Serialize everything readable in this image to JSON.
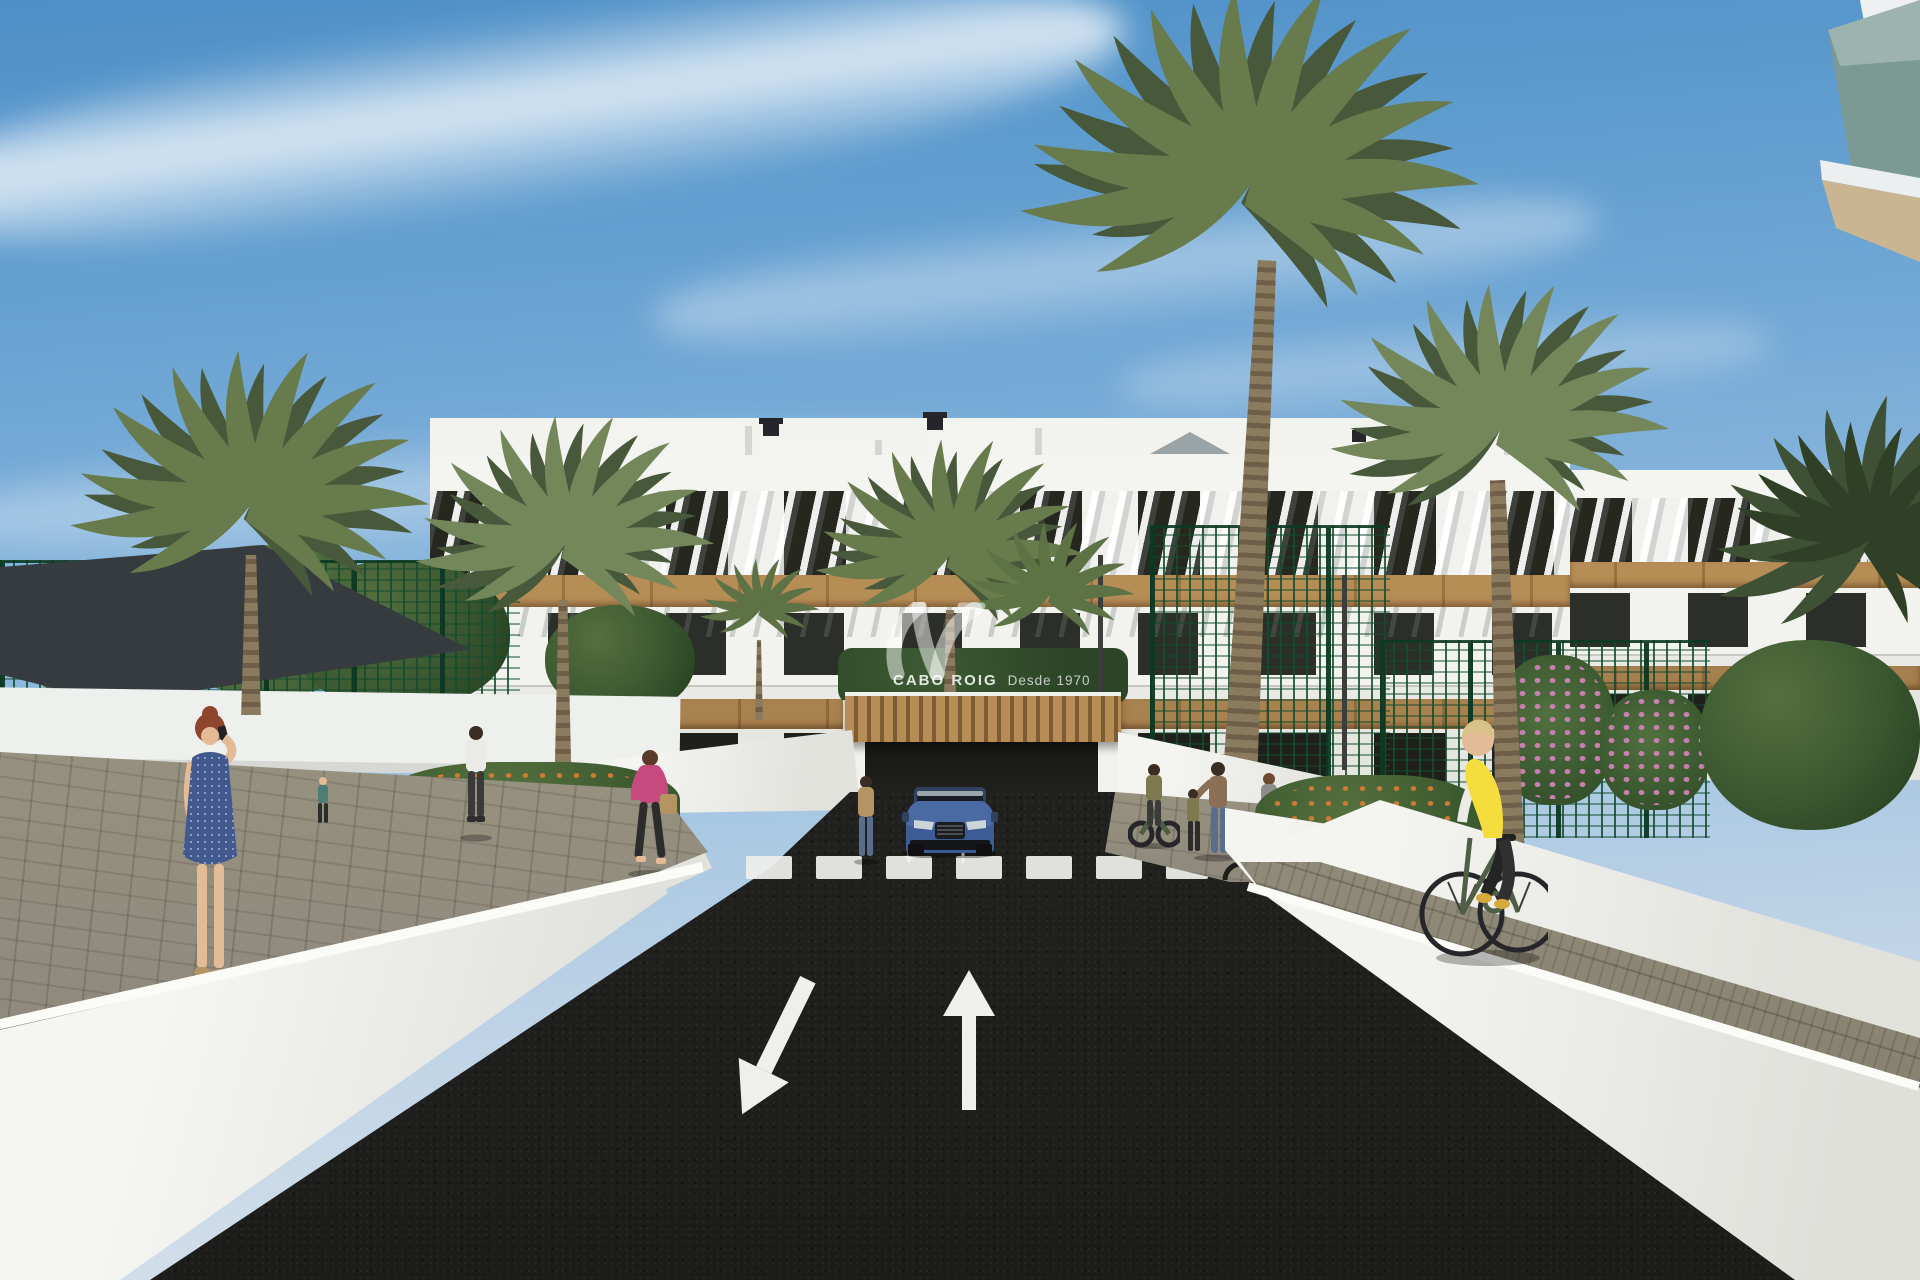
{
  "watermark": {
    "logo": "jv-wave-monogram",
    "brand": "CABO ROIG",
    "tagline": "Desde 1970"
  },
  "scene": {
    "type": "architectural-exterior-render",
    "setting": "street-level view of a modern white residential complex with palm trees",
    "elements": [
      "sky-with-cloud-streaks",
      "three-story-apartment-building",
      "rooftop-pergola-louvers",
      "wood-clad-bands",
      "palm-trees",
      "green-sports-court-fence",
      "shade-sail",
      "asphalt-road",
      "zebra-crosswalk",
      "lane-arrows",
      "underground-garage-entrance",
      "blue-suv",
      "pedestrians",
      "cyclist-in-yellow-vest",
      "white-perimeter-walls",
      "flower-beds",
      "bike-racks",
      "glass-balcony-corner"
    ]
  },
  "road_markings": {
    "crosswalk_stripes": 7,
    "large_lane_arrows": [
      "toward-viewer-left-lane",
      "away-from-viewer-right-lane"
    ],
    "small_ramp_arrows": [
      "down",
      "up"
    ]
  },
  "palette": {
    "sky_top": "#4e8fc7",
    "building_white": "#f2f2ee",
    "wall_white": "#efefec",
    "wood": "#b78d56",
    "wood_dark": "#9a7240",
    "glass_dark": "#26271f",
    "fence_green": "#1c5134",
    "palm_green": "#687b4c",
    "palm_dark": "#47593a",
    "asphalt": "#232321",
    "marking": "#efefec",
    "path_gray": "#8f897d",
    "cobble_gray": "#87816f",
    "car_blue": "#3d5c96",
    "vest_yellow": "#f5dd3d",
    "dress_blue": "#41598f",
    "jacket_pink": "#c64a7e",
    "skin": "#e4bb97",
    "hair_red": "#8e452c",
    "sail_dark": "#363b40",
    "flower_orange": "#d07a33",
    "flower_pink": "#c97fb0",
    "balcony_glass": "#7b9a94",
    "soffit_beige": "#c9b591"
  }
}
